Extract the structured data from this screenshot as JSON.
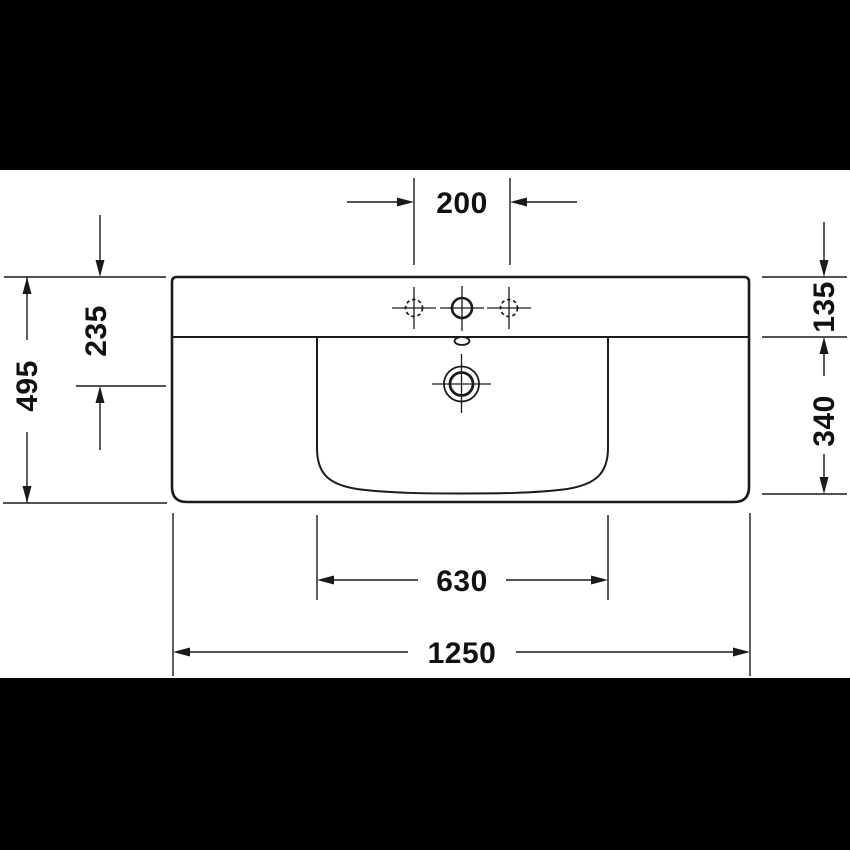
{
  "drawing": {
    "subject": "washbasin technical dimension drawing (top view)",
    "dimensions": {
      "tap_hole_spacing": "200",
      "drain_center_from_rear": "235",
      "overall_depth": "495",
      "rear_ledge_depth": "135",
      "basin_depth": "340",
      "basin_inner_width": "630",
      "overall_width": "1250"
    },
    "features": [
      "tap-hole-left",
      "tap-hole-center",
      "tap-hole-right",
      "overflow",
      "drain",
      "basin-inner-outline",
      "washbasin-outline"
    ],
    "colors": {
      "line": "#1a1a1a",
      "background": "#ffffff",
      "letterbox": "#000000"
    }
  }
}
